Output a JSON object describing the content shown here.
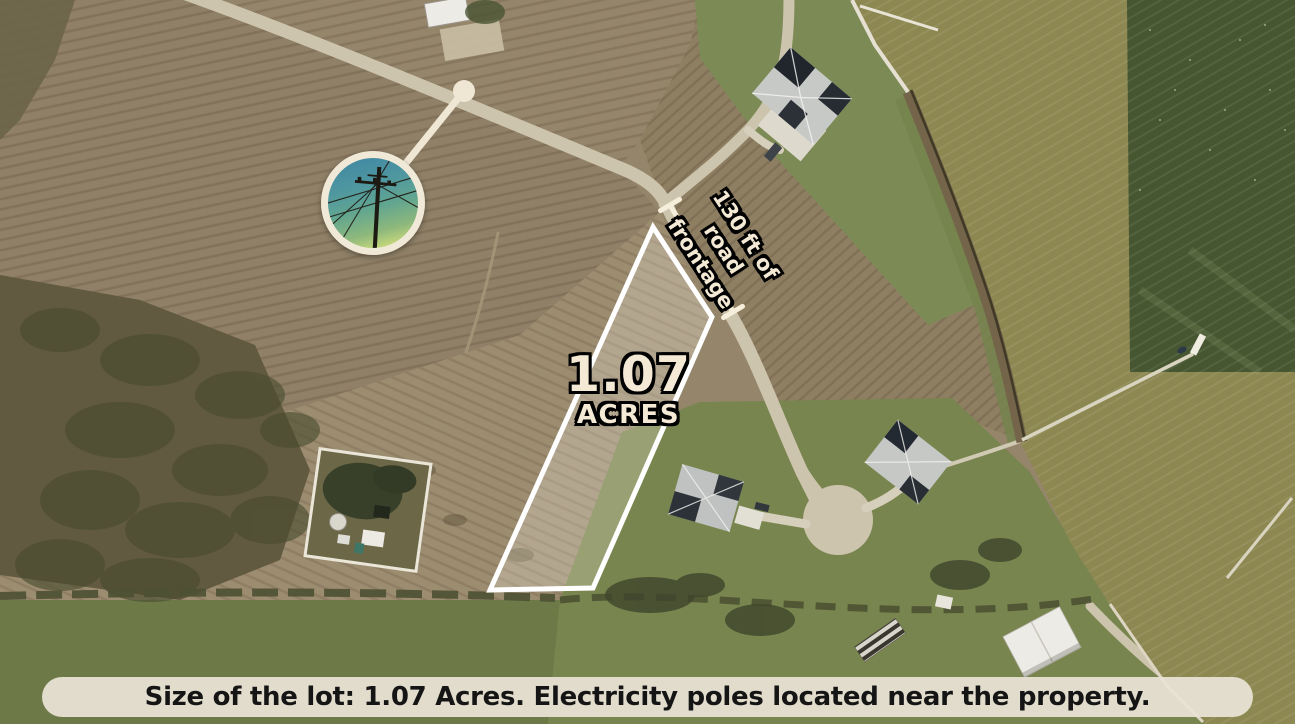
{
  "labels": {
    "area_value": "1.07",
    "area_unit": "ACRES",
    "frontage_line1": "130 ft of",
    "frontage_line2": "road frontage"
  },
  "caption": {
    "text": "Size of the lot: 1.07 Acres. Electricity poles located near the property."
  },
  "inset": {
    "subject": "electricity-pole-photo"
  },
  "map_features": {
    "lot_outline": "1.07 acre property boundary",
    "dimension": "130 ft road frontage bracket",
    "terrain": [
      "plowed fields",
      "scrub brush",
      "grass lawns",
      "bay water",
      "rural road",
      "cul-de-sac",
      "houses",
      "piers"
    ]
  },
  "colors": {
    "annotation_cream": "#f3e9d5",
    "boundary_white": "#ffffff",
    "caption_bg": "#eae3d6",
    "caption_text": "#151515",
    "field_tan": "#95866b",
    "road": "#cdc4ad",
    "grass": "#77854e",
    "water_olive": "#8d8852",
    "water_dark_green": "#465631"
  }
}
